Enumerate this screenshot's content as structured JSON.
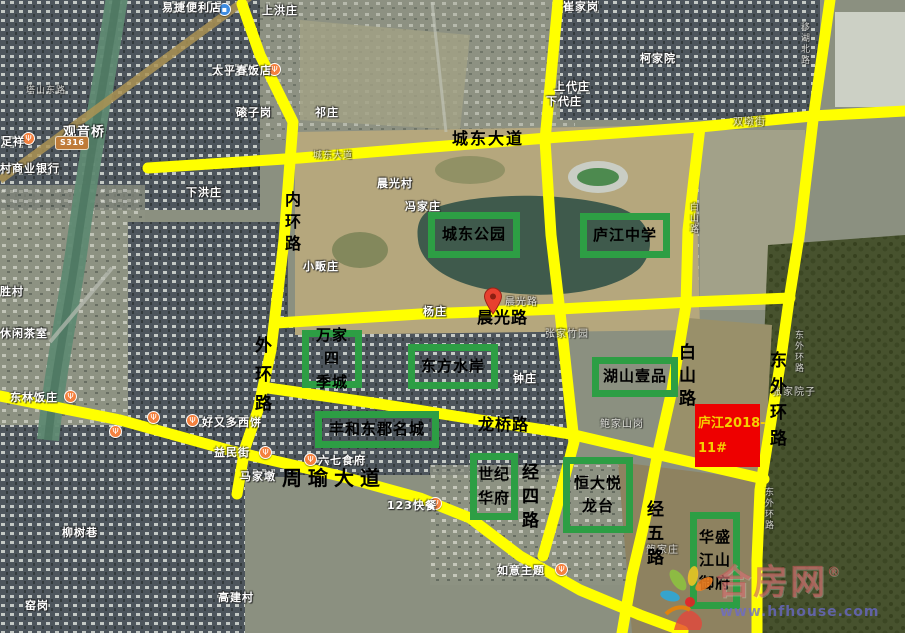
{
  "colors": {
    "road_overlay": "#ffff00",
    "annotation_box": "#2d9e44",
    "parcel_fill": "#ee0000",
    "parcel_text": "#f6cf00"
  },
  "map": {
    "route_shield": "S316",
    "parcel": {
      "line1": "庐江2018-",
      "line2": "11#"
    },
    "watermark": {
      "brand": "合房网",
      "registered": "®",
      "url": "www.hfhouse.com"
    },
    "overlay_labels": [
      {
        "t": "城东大道",
        "x": 452,
        "y": 131,
        "s": 16,
        "ls": 2,
        "v": false
      },
      {
        "t": "内环路",
        "x": 283,
        "y": 191,
        "s": 16,
        "ls": 6,
        "v": true
      },
      {
        "t": "外环路",
        "x": 252,
        "y": 336,
        "s": 17,
        "ls": 12,
        "v": true
      },
      {
        "t": "晨光路",
        "x": 477,
        "y": 310,
        "s": 16,
        "ls": 1,
        "v": false
      },
      {
        "t": "龙桥路",
        "x": 478,
        "y": 417,
        "s": 16,
        "ls": 1,
        "v": false
      },
      {
        "t": "周瑜大道",
        "x": 282,
        "y": 468,
        "s": 20,
        "ls": 6,
        "v": false
      },
      {
        "t": "白山路",
        "x": 676,
        "y": 343,
        "s": 17,
        "ls": 6,
        "v": true
      },
      {
        "t": "东外环路",
        "x": 767,
        "y": 351,
        "s": 17,
        "ls": 9,
        "v": true
      },
      {
        "t": "经四路",
        "x": 519,
        "y": 463,
        "s": 17,
        "ls": 7,
        "v": true
      },
      {
        "t": "经五路",
        "x": 644,
        "y": 500,
        "s": 17,
        "ls": 7,
        "v": true
      }
    ],
    "green_boxes": [
      {
        "name": "chengdong-park",
        "lines": [
          "城东公园"
        ],
        "x": 428,
        "y": 212,
        "w": 92,
        "h": 46
      },
      {
        "name": "lujiang-middle-school",
        "lines": [
          "庐江中学"
        ],
        "x": 580,
        "y": 213,
        "w": 90,
        "h": 45
      },
      {
        "name": "wanjia-sijicheng",
        "lines": [
          "万家四",
          "季城"
        ],
        "x": 302,
        "y": 330,
        "w": 60,
        "h": 58
      },
      {
        "name": "dongfang-shuian",
        "lines": [
          "东方水岸"
        ],
        "x": 408,
        "y": 344,
        "w": 90,
        "h": 45
      },
      {
        "name": "hushan-yipin",
        "lines": [
          "湖山壹品"
        ],
        "x": 592,
        "y": 357,
        "w": 86,
        "h": 40
      },
      {
        "name": "fenghe-dongjun-mingcheng",
        "lines": [
          "丰和东郡名城"
        ],
        "x": 315,
        "y": 411,
        "w": 124,
        "h": 37
      },
      {
        "name": "shiji-huafu",
        "lines": [
          "世纪",
          "华府"
        ],
        "x": 470,
        "y": 453,
        "w": 48,
        "h": 67
      },
      {
        "name": "hengda-yuelongtai",
        "lines": [
          "恒大悦",
          "龙台"
        ],
        "x": 563,
        "y": 457,
        "w": 70,
        "h": 76
      },
      {
        "name": "huasheng-jiangshan-yufu",
        "lines": [
          "华盛",
          "江山",
          "御府"
        ],
        "x": 690,
        "y": 512,
        "w": 50,
        "h": 97
      }
    ],
    "base_labels": [
      {
        "t": "上洪庄",
        "x": 262,
        "y": 5
      },
      {
        "t": "崔家岗",
        "x": 563,
        "y": 1
      },
      {
        "t": "塔山东路",
        "x": 26,
        "y": 87,
        "gray": true,
        "s": 9
      },
      {
        "t": "观音桥",
        "x": 63,
        "y": 126,
        "s": 13
      },
      {
        "t": "磙子岗",
        "x": 236,
        "y": 107
      },
      {
        "t": "祁庄",
        "x": 315,
        "y": 107
      },
      {
        "t": "柯家院",
        "x": 640,
        "y": 53
      },
      {
        "t": "上代庄",
        "x": 554,
        "y": 81
      },
      {
        "t": "下代庄",
        "x": 546,
        "y": 96
      },
      {
        "t": "双墩街",
        "x": 733,
        "y": 118,
        "gray": true,
        "s": 10
      },
      {
        "t": "移湖北路",
        "x": 799,
        "y": 22,
        "gray": true,
        "s": 9,
        "v": true
      },
      {
        "t": "城东大道",
        "x": 313,
        "y": 152,
        "gray": true,
        "s": 9
      },
      {
        "t": "下洪庄",
        "x": 186,
        "y": 187
      },
      {
        "t": "晨光村",
        "x": 377,
        "y": 178
      },
      {
        "t": "冯家庄",
        "x": 405,
        "y": 201
      },
      {
        "t": "小畈庄",
        "x": 303,
        "y": 261
      },
      {
        "t": "杨庄",
        "x": 423,
        "y": 306
      },
      {
        "t": "晨光路",
        "x": 505,
        "y": 298,
        "gray": true,
        "s": 10
      },
      {
        "t": "白山路",
        "x": 688,
        "y": 202,
        "gray": true,
        "s": 9,
        "v": true
      },
      {
        "t": "张家竹园",
        "x": 545,
        "y": 330,
        "gray": true,
        "s": 10
      },
      {
        "t": "钟庄",
        "x": 513,
        "y": 373
      },
      {
        "t": "张家院子",
        "x": 772,
        "y": 388,
        "gray": true,
        "s": 10
      },
      {
        "t": "鲍家山岗",
        "x": 600,
        "y": 420,
        "gray": true,
        "s": 10
      },
      {
        "t": "东外环路",
        "x": 793,
        "y": 330,
        "gray": true,
        "s": 9,
        "v": true
      },
      {
        "t": "东外环路",
        "x": 763,
        "y": 487,
        "gray": true,
        "s": 9,
        "v": true
      },
      {
        "t": "鲍家庄",
        "x": 646,
        "y": 546,
        "gray": true,
        "s": 10
      },
      {
        "t": "胜村",
        "x": 0,
        "y": 286
      },
      {
        "t": "休闲茶室",
        "x": 0,
        "y": 328
      },
      {
        "t": "村商业银行",
        "x": 0,
        "y": 163
      },
      {
        "t": "马家墩",
        "x": 240,
        "y": 471
      },
      {
        "t": "柳树巷",
        "x": 62,
        "y": 527
      },
      {
        "t": "窑岗",
        "x": 25,
        "y": 600
      },
      {
        "t": "高建村",
        "x": 218,
        "y": 592
      }
    ],
    "poi_markers": [
      {
        "label": "易捷便利店",
        "lx": 162,
        "ly": 2,
        "mx": 218,
        "my": 3,
        "type": "blue"
      },
      {
        "label": "太平春饭店",
        "lx": 212,
        "ly": 65,
        "mx": 268,
        "my": 63,
        "type": "orange"
      },
      {
        "label": "足祥",
        "lx": 1,
        "ly": 136,
        "mx": 22,
        "my": 132,
        "type": "orange"
      },
      {
        "label": "东林饭庄",
        "lx": 10,
        "ly": 392,
        "mx": 64,
        "my": 390,
        "type": "orange"
      },
      {
        "label": "好又多西饼",
        "lx": 202,
        "ly": 417,
        "mx": 186,
        "my": 414,
        "type": "orange"
      },
      {
        "label": "",
        "lx": 0,
        "ly": 0,
        "mx": 147,
        "my": 411,
        "type": "orange"
      },
      {
        "label": "",
        "lx": 0,
        "ly": 0,
        "mx": 109,
        "my": 425,
        "type": "orange"
      },
      {
        "label": "益民街",
        "lx": 214,
        "ly": 447,
        "mx": 259,
        "my": 446,
        "type": "orange"
      },
      {
        "label": "六七食府",
        "lx": 318,
        "ly": 455,
        "mx": 304,
        "my": 453,
        "type": "orange"
      },
      {
        "label": "123快餐",
        "lx": 387,
        "ly": 500,
        "mx": 429,
        "my": 497,
        "type": "orange"
      },
      {
        "label": "如意主题",
        "lx": 497,
        "ly": 565,
        "mx": 555,
        "my": 563,
        "type": "orange"
      }
    ]
  }
}
